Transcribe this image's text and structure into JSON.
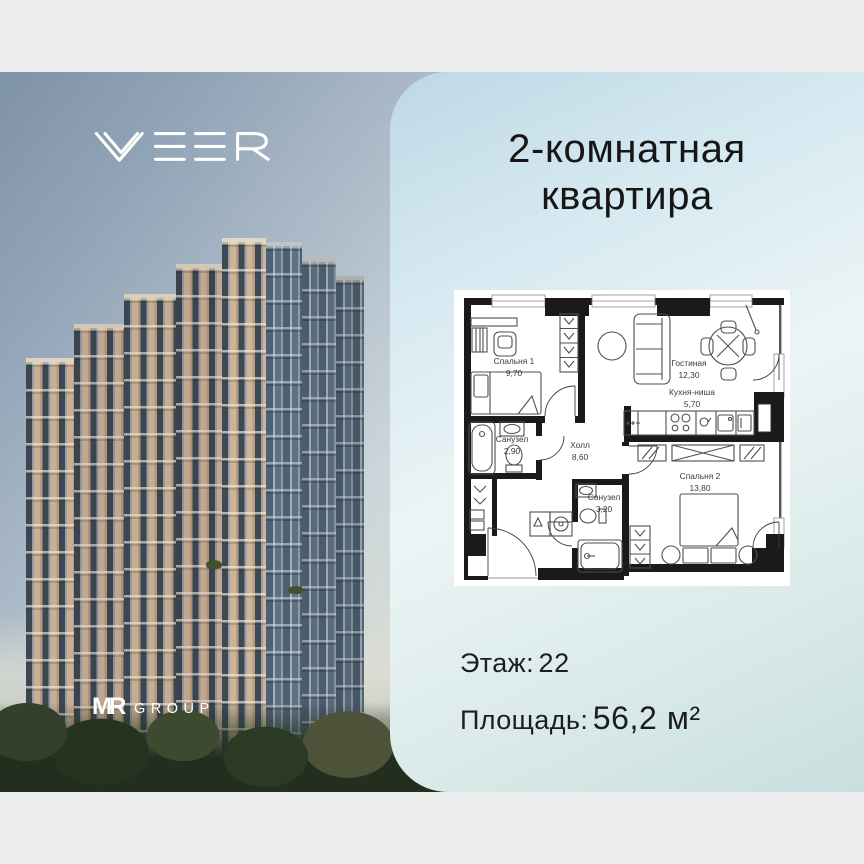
{
  "brand": {
    "name": "VEER"
  },
  "developer": {
    "mr": "MR",
    "group": "GROUP"
  },
  "title": {
    "line1": "2-комнатная",
    "line2": "квартира"
  },
  "plan": {
    "rooms": [
      {
        "name": "Спальня 1",
        "area": "9,70"
      },
      {
        "name": "Гостиная",
        "area": "12,30"
      },
      {
        "name": "Кухня-ниша",
        "area": "5,70"
      },
      {
        "name": "Санузел",
        "area": "2,90"
      },
      {
        "name": "Холл",
        "area": "8,60"
      },
      {
        "name": "Санузел",
        "area": "3,20"
      },
      {
        "name": "Спальня 2",
        "area": "13,80"
      }
    ]
  },
  "details": {
    "floor_label": "Этаж:",
    "floor_value": "22",
    "area_label": "Площадь:",
    "area_value": "56,2 м²"
  },
  "colors": {
    "band": "#edefee",
    "panel_top": "#bed8e6",
    "panel_mid": "#ecf4f6",
    "wall": "#1a1a1a"
  }
}
